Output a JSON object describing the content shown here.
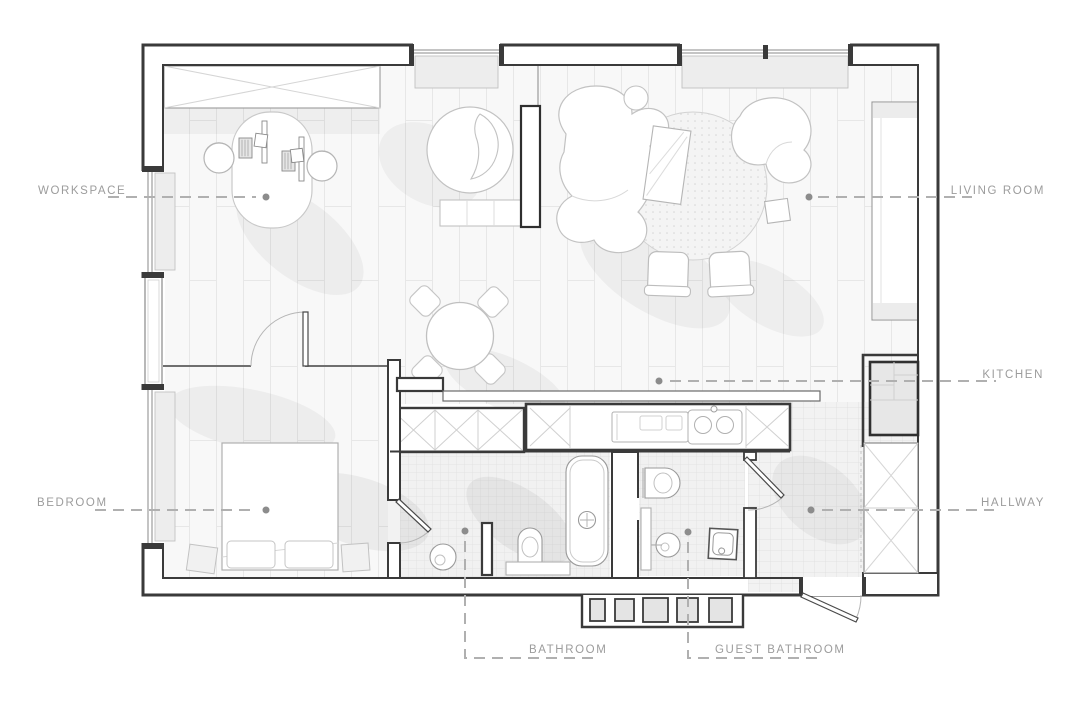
{
  "plan": {
    "labels": {
      "workspace": "WORKSPACE",
      "living_room": "LIVING ROOM",
      "kitchen": "KITCHEN",
      "bedroom": "BEDROOM",
      "hallway": "HALLWAY",
      "bathroom": "BATHROOM",
      "guest_bathroom": "GUEST BATHROOM"
    },
    "colors": {
      "background": "#ffffff",
      "wall": "#3a3a3a",
      "label_text": "#9c9c9c",
      "leader_line": "#b0b0b0",
      "leader_dot": "#8c8c8c",
      "plank_line": "#e7e7e7",
      "tile_line": "#e0e0e0",
      "furniture_line": "#bdbdbd",
      "shadow": "rgba(0,0,0,0.05)"
    }
  }
}
